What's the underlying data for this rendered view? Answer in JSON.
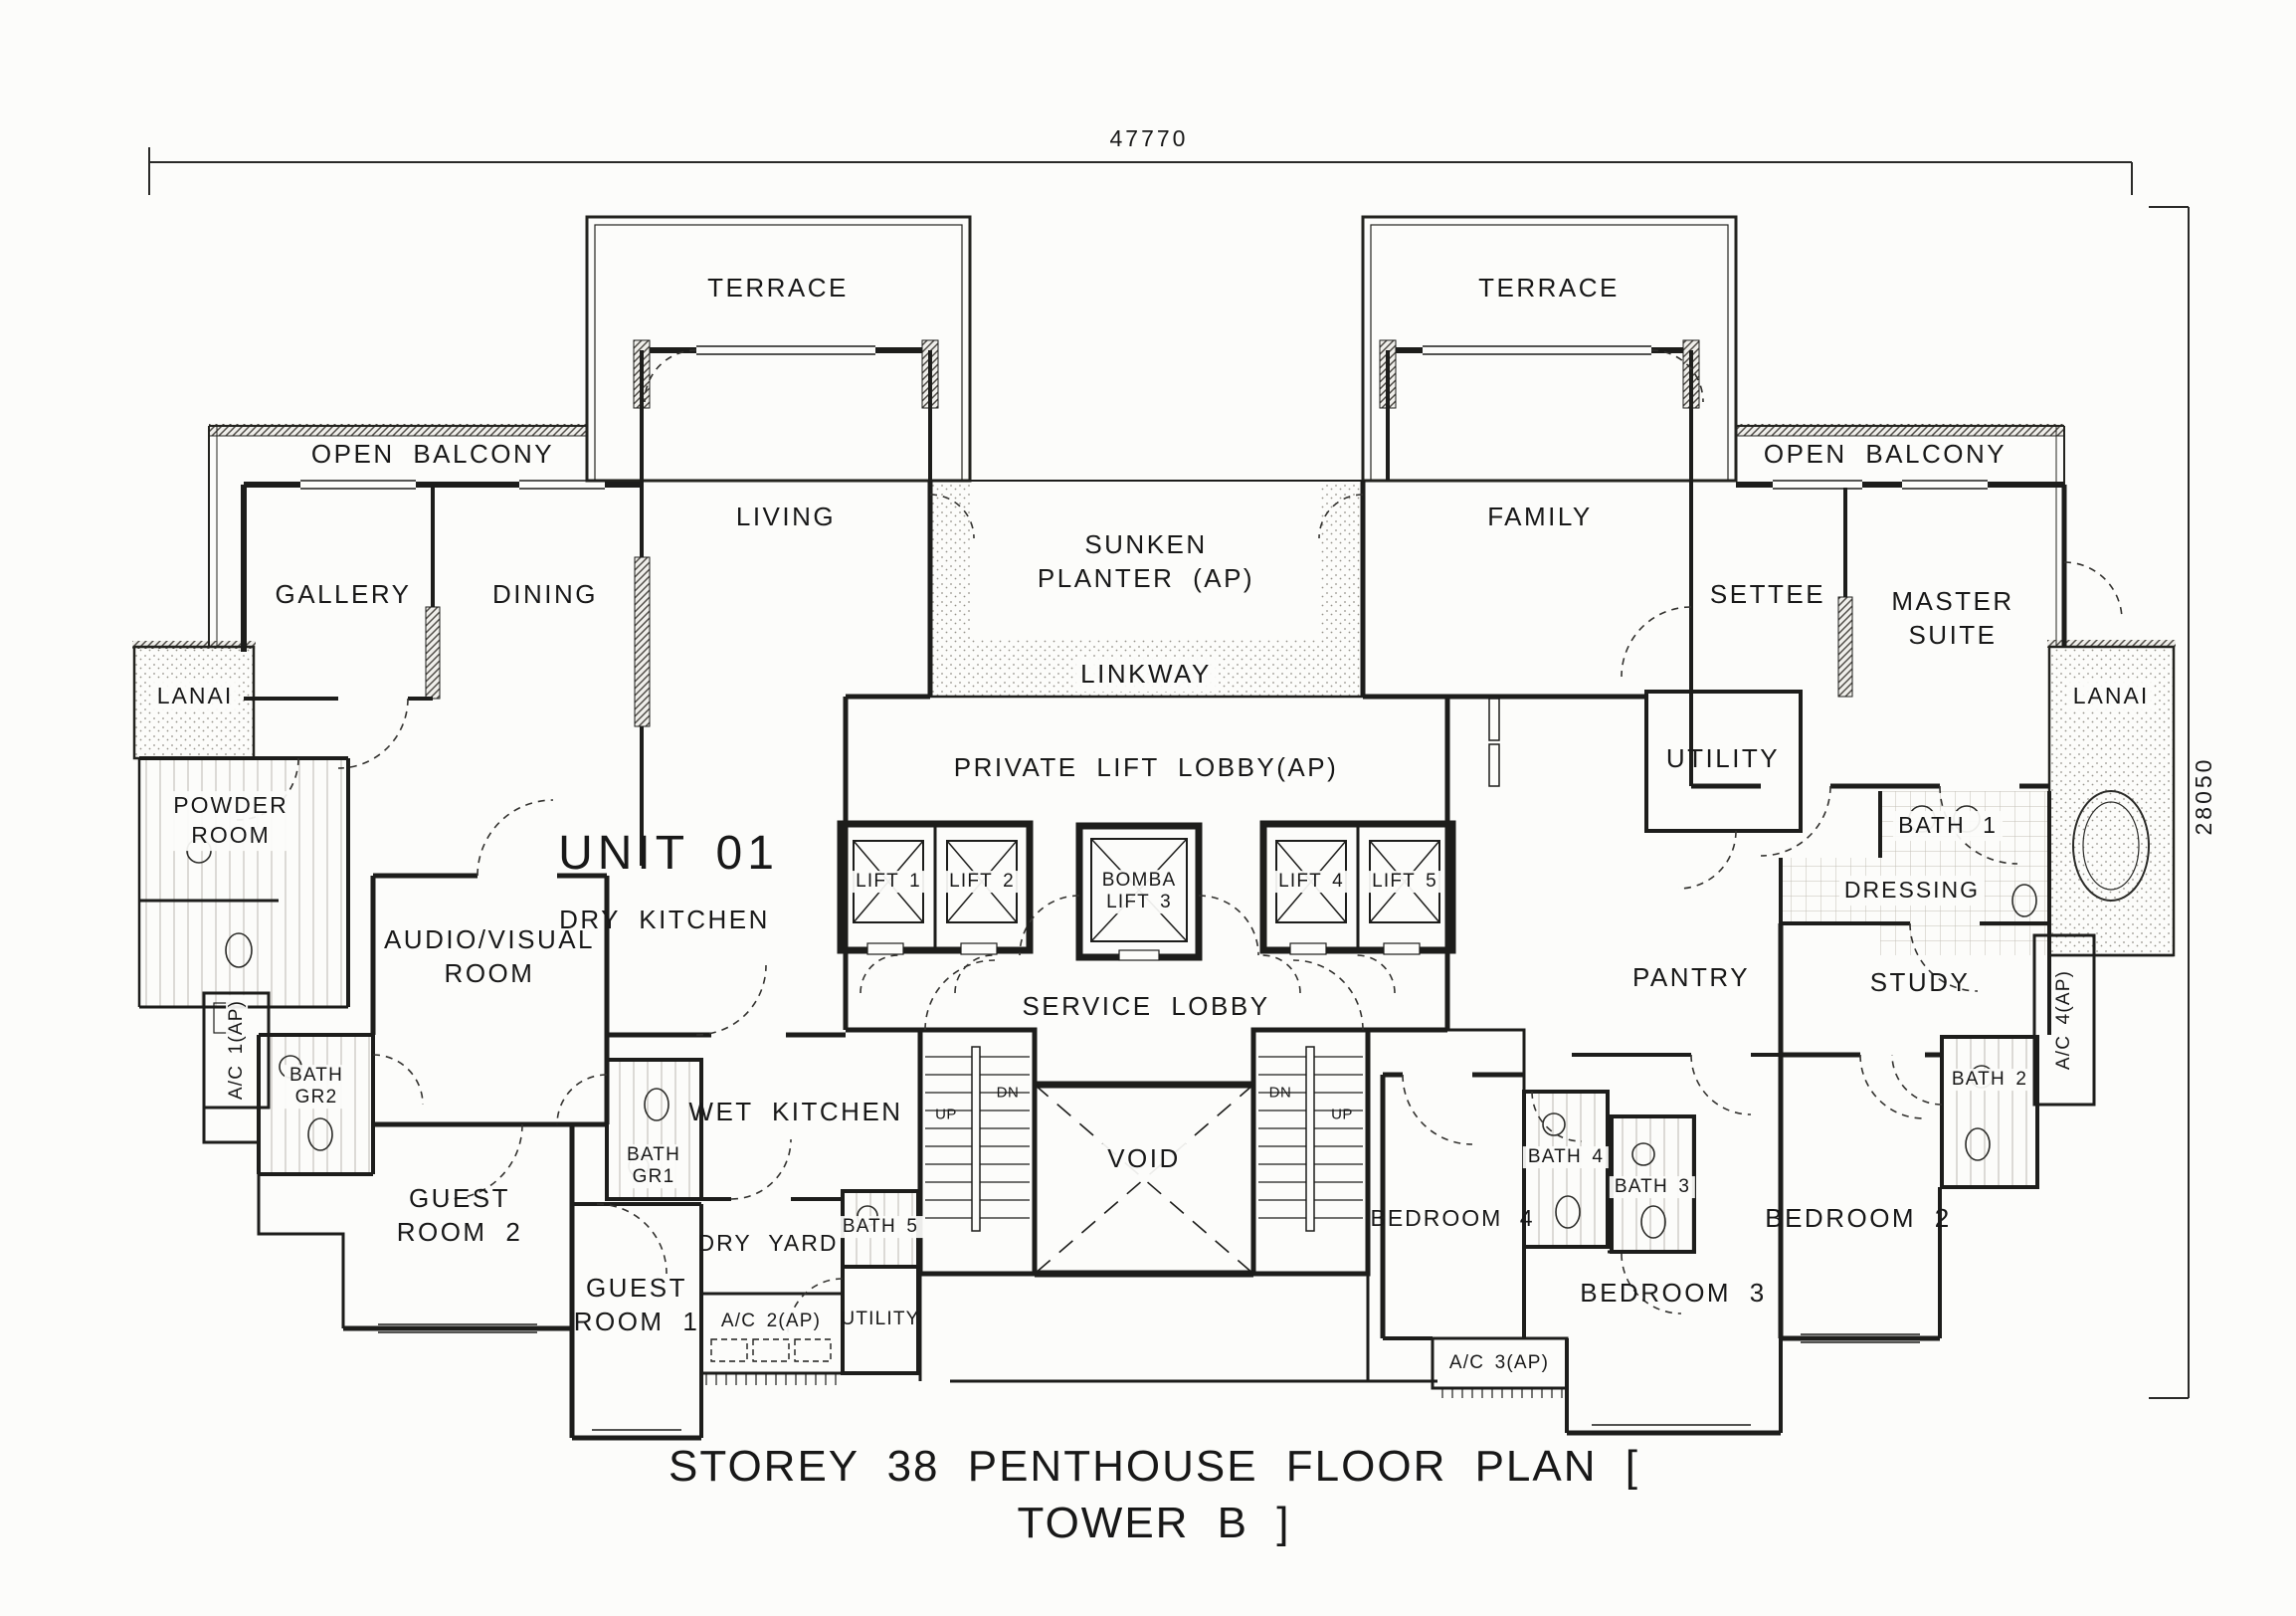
{
  "title": "STOREY 38 PENTHOUSE FLOOR PLAN  [ TOWER B ]",
  "dimensions": {
    "width_mm": "47770",
    "height_mm": "28050"
  },
  "unit": {
    "name": "UNIT 01"
  },
  "rooms": {
    "terrace_left": "TERRACE",
    "terrace_right": "TERRACE",
    "open_balcony_left": "OPEN BALCONY",
    "open_balcony_right": "OPEN BALCONY",
    "gallery": "GALLERY",
    "dining": "DINING",
    "living": "LIVING",
    "family": "FAMILY",
    "lanai_left": "LANAI",
    "lanai_right": "LANAI",
    "powder_room": "POWDER\nROOM",
    "audio_visual_room": "AUDIO/VISUAL\nROOM",
    "dry_kitchen": "DRY KITCHEN",
    "wet_kitchen": "WET KITCHEN",
    "dry_yard": "DRY YARD",
    "guest_room_1": "GUEST\nROOM 1",
    "guest_room_2": "GUEST\nROOM 2",
    "bath_gr1": "BATH\nGR1",
    "bath_gr2": "BATH\nGR2",
    "bath_5": "BATH 5",
    "utility_unit01": "UTILITY",
    "utility_unit02": "UTILITY",
    "settee": "SETTEE",
    "master_suite": "MASTER\nSUITE",
    "study": "STUDY",
    "pantry": "PANTRY",
    "dressing": "DRESSING",
    "bath_1": "BATH 1",
    "bath_2": "BATH 2",
    "bath_3": "BATH 3",
    "bath_4": "BATH 4",
    "bedroom_2": "BEDROOM 2",
    "bedroom_3": "BEDROOM 3",
    "bedroom_4": "BEDROOM 4"
  },
  "core": {
    "sunken_planter": "SUNKEN\nPLANTER (AP)",
    "linkway": "LINKWAY",
    "private_lift_lobby": "PRIVATE LIFT LOBBY(AP)",
    "service_lobby": "SERVICE LOBBY",
    "lift_1": "LIFT 1",
    "lift_2": "LIFT 2",
    "bomba_lift_3": "BOMBA\nLIFT 3",
    "lift_4": "LIFT 4",
    "lift_5": "LIFT 5",
    "void": "VOID",
    "stair_up": "UP",
    "stair_down": "DN"
  },
  "ac_ledges": {
    "ac_1": "A/C 1(AP)",
    "ac_2": "A/C 2(AP)",
    "ac_3": "A/C 3(AP)",
    "ac_4": "A/C 4(AP)"
  }
}
